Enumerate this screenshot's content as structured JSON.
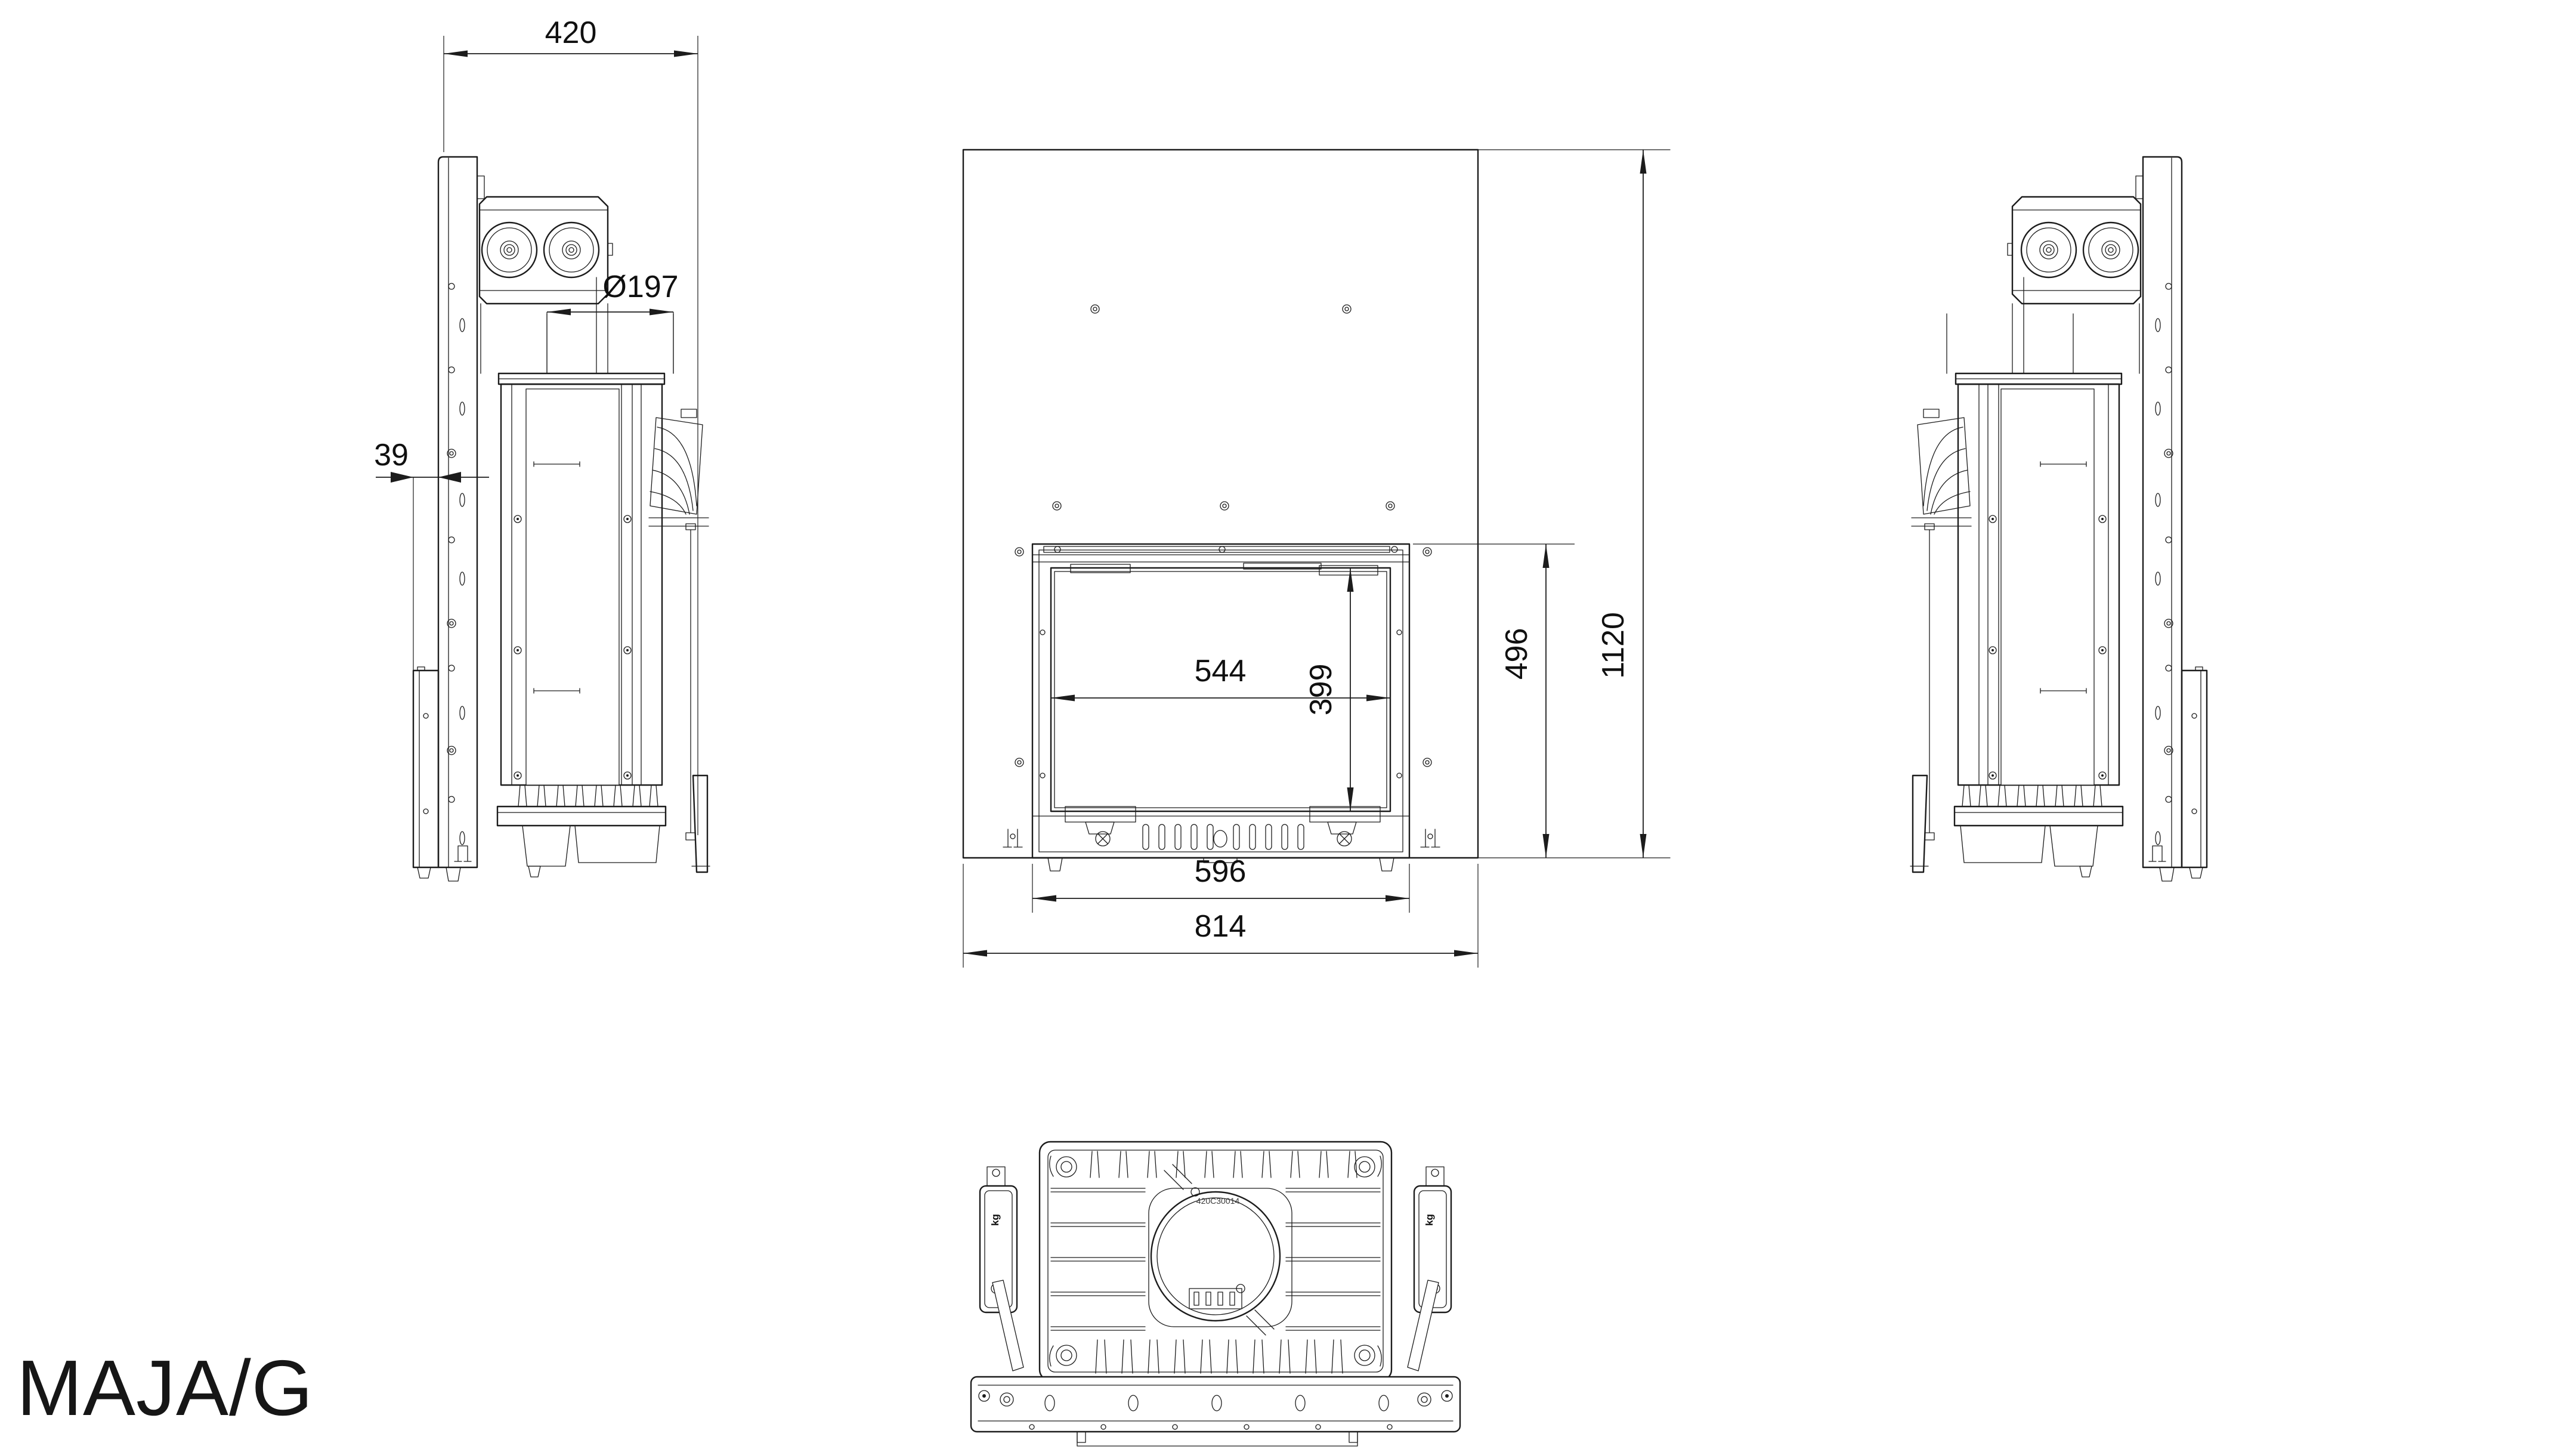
{
  "drawing": {
    "product_label": "MAJA/G",
    "stamp": "420C30014",
    "weight_unit_label": "kg",
    "dimensions": {
      "side_overall_depth": "420",
      "flue_diameter": "Ø197",
      "wall_offset": "39",
      "glass_width": "544",
      "glass_height": "399",
      "insert_height": "496",
      "frame_height": "1120",
      "insert_width": "596",
      "frame_width": "814"
    },
    "colors": {
      "line": "#1c1c1c",
      "background": "#ffffff"
    }
  }
}
